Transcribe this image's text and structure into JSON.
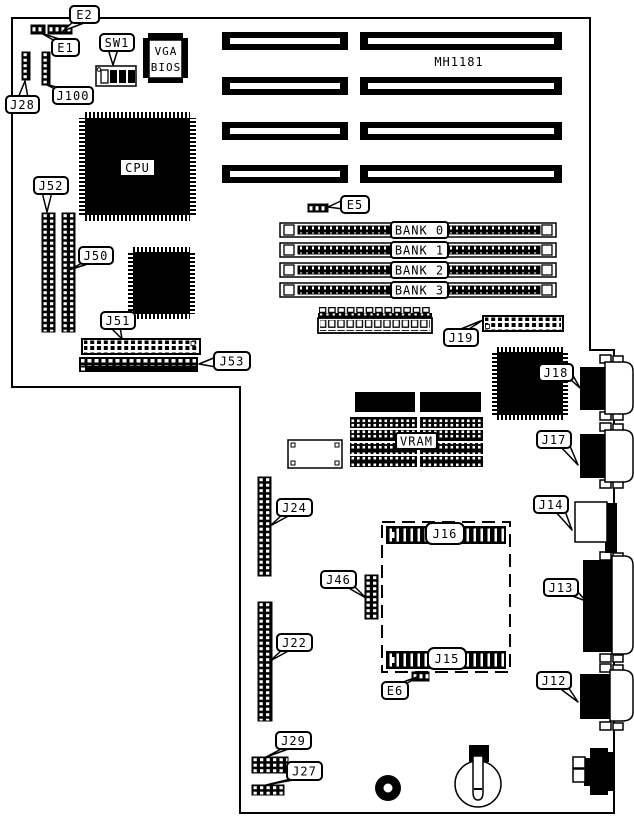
{
  "board": {
    "part_number": "MH1181",
    "chip_labels": {
      "cpu": "CPU",
      "vga_bios_line1": "VGA",
      "vga_bios_line2": "BIOS",
      "vram": "VRAM"
    },
    "memory_banks": [
      "BANK 0",
      "BANK 1",
      "BANK 2",
      "BANK 3"
    ],
    "jumpers": {
      "e1": "E1",
      "e2": "E2",
      "e5": "E5",
      "e6": "E6"
    },
    "switches": {
      "sw1": "SW1"
    },
    "connectors": {
      "j12": "J12",
      "j13": "J13",
      "j14": "J14",
      "j15": "J15",
      "j16": "J16",
      "j17": "J17",
      "j18": "J18",
      "j19": "J19",
      "j22": "J22",
      "j24": "J24",
      "j27": "J27",
      "j28": "J28",
      "j29": "J29",
      "j46": "J46",
      "j50": "J50",
      "j51": "J51",
      "j52": "J52",
      "j53": "J53",
      "j100": "J100"
    },
    "colors": {
      "ink": "#000000",
      "paper": "#ffffff"
    }
  }
}
